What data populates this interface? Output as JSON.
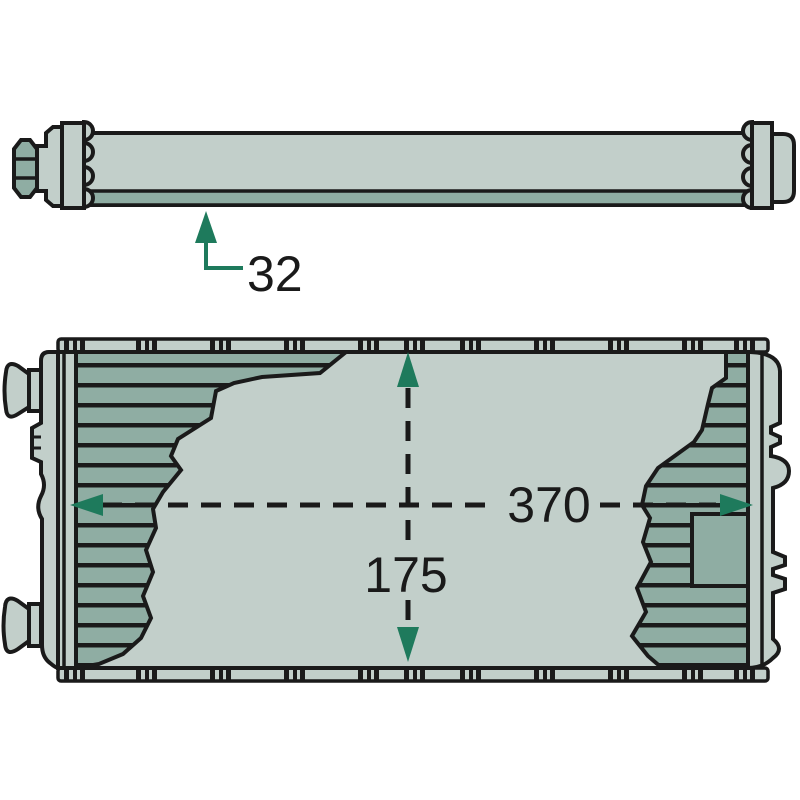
{
  "drawing": {
    "description": "heat-exchanger-dimensional-drawing",
    "views": {
      "side_view": "side-profile",
      "front_view": "front-face"
    }
  },
  "colors": {
    "outline": "#1a1a1a",
    "fill_light": "#c2cfca",
    "fill_dark": "#8fada3",
    "accent_teal": "#1e7a5c",
    "background": "#ffffff",
    "text": "#1a1a1a"
  },
  "dimensions": {
    "depth": {
      "label": "32"
    },
    "width": {
      "label": "370"
    },
    "height": {
      "label": "175"
    }
  }
}
